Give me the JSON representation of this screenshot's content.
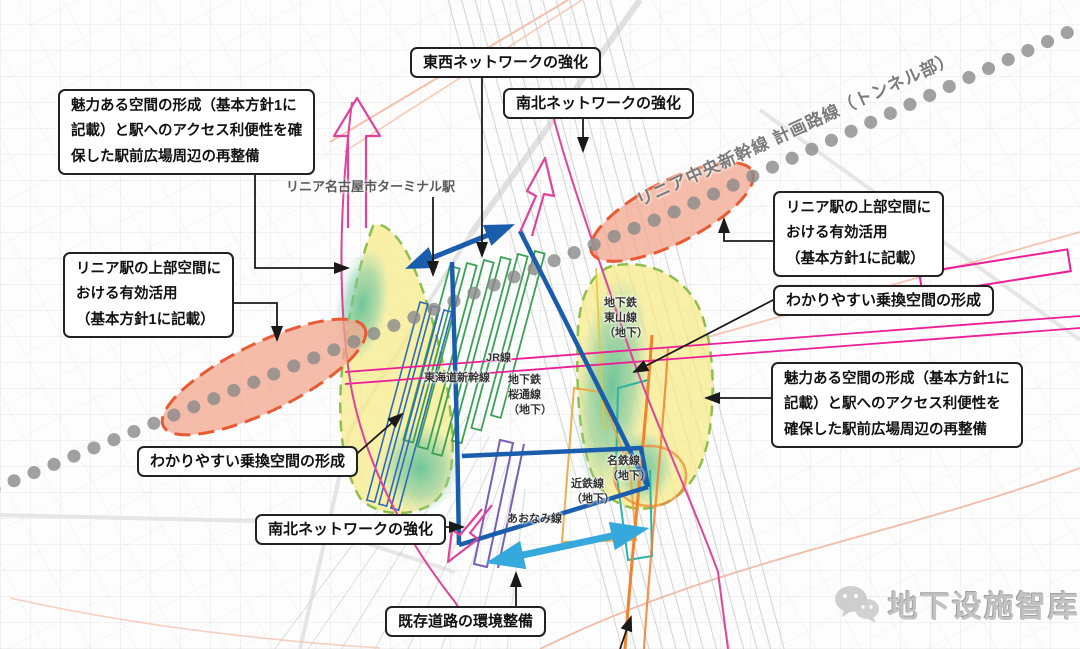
{
  "callouts": {
    "tozai_network": "東西ネットワークの強化",
    "nanboku_network_top": "南北ネットワークの強化",
    "nanboku_network_bottom": "南北ネットワークの強化",
    "kizon_road": "既存道路の環境整備",
    "wakari_left": "わかりやすい乗換空間の形成",
    "wakari_right": "わかりやすい乗換空間の形成",
    "miryoku_left_lines": [
      "魅力ある空間の形成（基本方針1に",
      "記載）と駅へのアクセス利便性を確",
      "保した駅前広場周辺の再整備"
    ],
    "miryoku_right_lines": [
      "魅力ある空間の形成（基本方針1に",
      "記載）と駅へのアクセス利便性を",
      "確保した駅前広場周辺の再整備"
    ],
    "linear_left_lines": [
      "リニア駅の上部空間に",
      "おける有効活用",
      "（基本方針1に記載）"
    ],
    "linear_right_lines": [
      "リニア駅の上部空間に",
      "おける有効活用",
      "（基本方針1に記載）"
    ]
  },
  "map_labels": {
    "terminal_station": "リニア名古屋市ターミナル駅",
    "linear_route": "リニア中央新幹線 計画路線（トンネル部）",
    "jr_line": "JR線",
    "tokaido_shinkansen": "東海道新幹線",
    "sakuradori_subway": "地下鉄\n桜通線\n（地下）",
    "higashiyama_subway": "地下鉄\n東山線\n（地下）",
    "meitetsu_line": "名鉄線\n（地下）",
    "kintetsu_line": "近鉄線\n（地下）",
    "aonami_line": "あおなみ線"
  },
  "watermark": {
    "icon": "wechat-icon",
    "text": "地下设施智库"
  },
  "colors": {
    "station_blue": "#1A5DAD",
    "network_cyan": "#35A8DC",
    "jr_green": "#3AA255",
    "shinkansen_blue": "#2B6CB8",
    "subway_magenta": "#ED1E98",
    "pink_arrow": "#E0439A",
    "orange_line": "#F08330",
    "kintetsu_orange": "#F0A43C",
    "meitetsu_teal": "#2BB3A8",
    "aonami_purple": "#7A5FB8",
    "zone_yellow": "#F7EA86",
    "zone_border_green": "#8FBE4D",
    "zone_gradient_teal": "#5FBF9A",
    "linear_ellipse_fill": "#F2A58C",
    "linear_ellipse_stroke": "#E85A33",
    "linear_dots_gray": "#8A8A8A",
    "connector_black": "#1a1a1a"
  }
}
